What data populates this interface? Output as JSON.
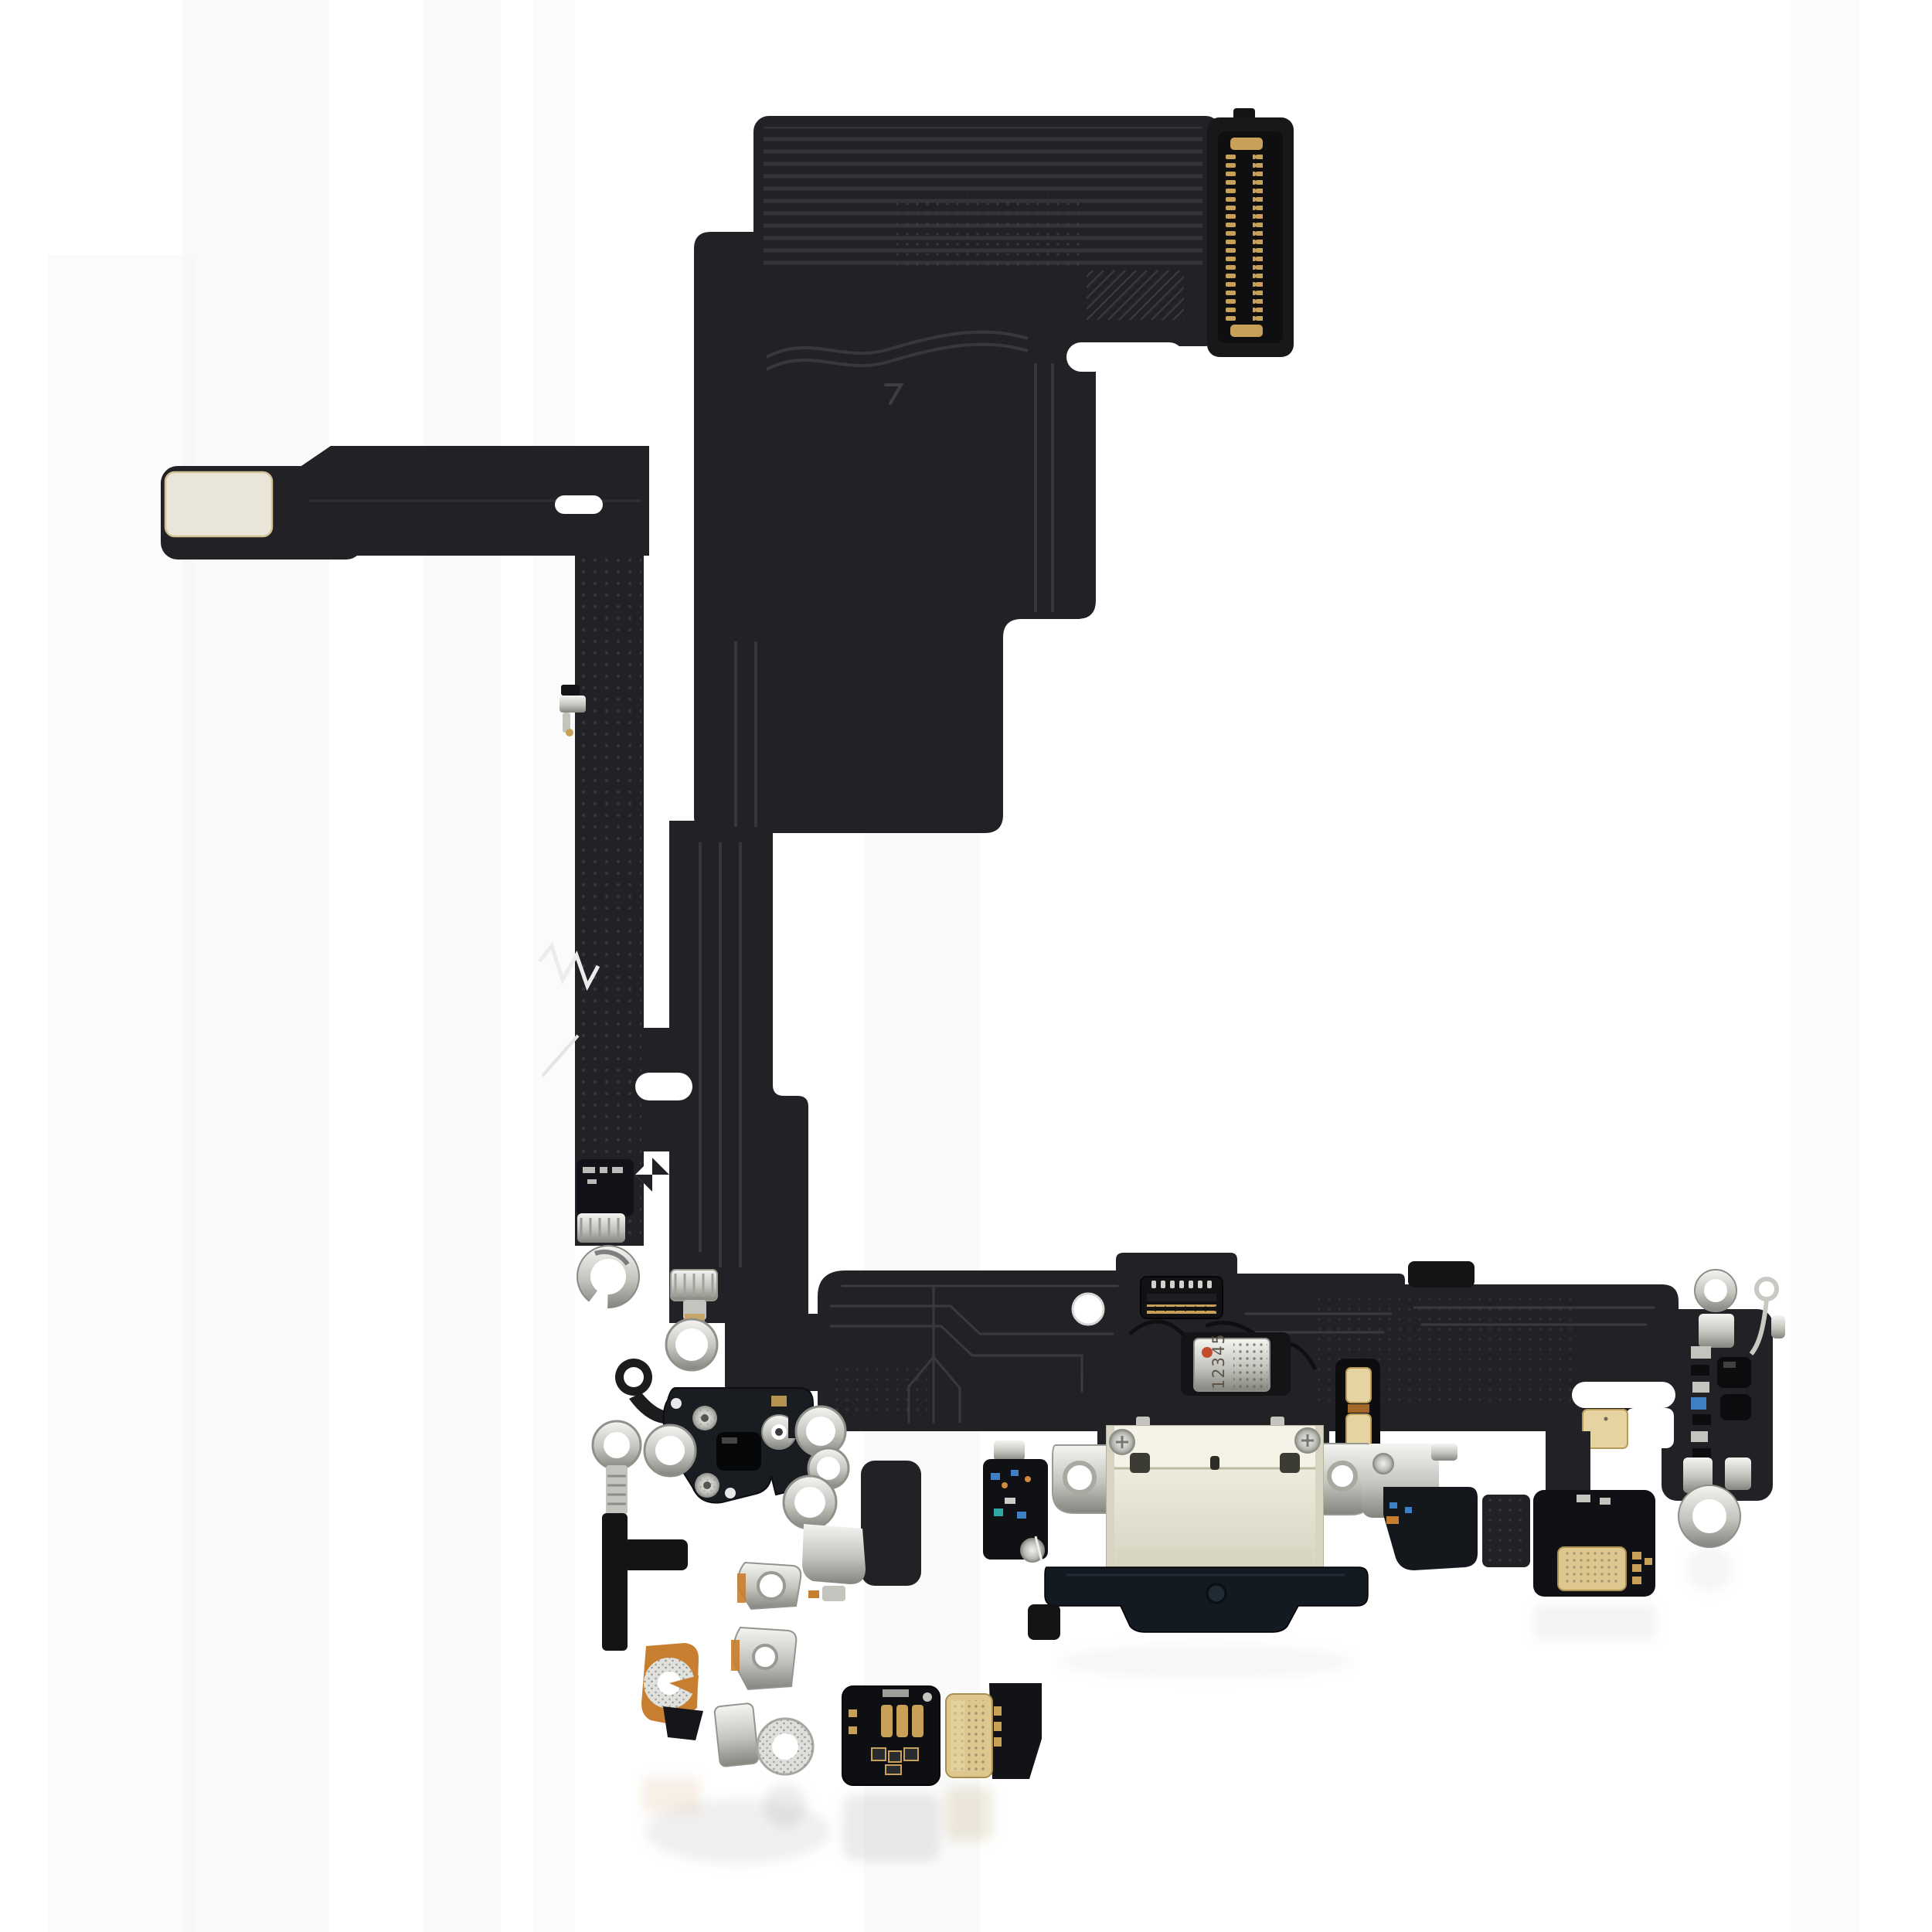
{
  "scene": {
    "kind": "product-photo",
    "subject": "smartphone-charging-port-flex-cable",
    "background": "#ffffff"
  },
  "labels": {
    "mic_marking": "12345"
  },
  "colors": {
    "background": "#ffffff",
    "flexDark": "#222226",
    "flexDarker": "#141417",
    "flexLight": "#2e2f33",
    "trace": "#3e3f45",
    "connector": "#18181b",
    "goldPin": "#c8a158",
    "goldPad": "#e5d3a2",
    "goldMic": "#ddc78f",
    "metalLight": "#f4f4f1",
    "metalMid": "#c4c4bf",
    "metalDark": "#85857f",
    "orange": "#c87e2f",
    "shield": "#eae6d6",
    "boot": "#131a22",
    "blue": "#3f7fc4",
    "micDot": "#c34a2a",
    "reflect": "#9b9b99"
  },
  "parts": {
    "board_connector": "board-to-board-connector",
    "left_arm": "antenna-flex-arm",
    "usb_port": "usb-c-charging-port",
    "microphone": "bottom-microphone",
    "right_module": "wifi-antenna-module",
    "grounding_rings": "grounding-eyelets"
  }
}
